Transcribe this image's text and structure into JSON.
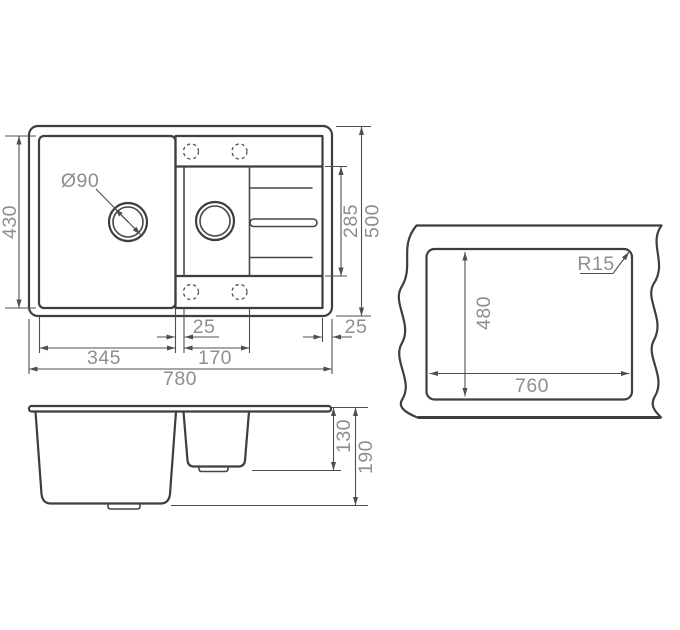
{
  "top_view": {
    "labels": {
      "total_width": "780",
      "main_bowl_width": "345",
      "bowl_gap": "25",
      "small_bowl_width": "170",
      "edge_offset": "25",
      "main_bowl_length": "430",
      "drain_section_length": "285",
      "total_length": "500",
      "drain_hole_diameter": "Ø90"
    }
  },
  "side_view": {
    "labels": {
      "small_bowl_depth": "130",
      "main_bowl_depth": "190"
    }
  },
  "cutout_view": {
    "labels": {
      "cutout_width": "760",
      "cutout_height": "480",
      "corner_radius": "R15"
    }
  },
  "colors": {
    "line": "#3e3e3e",
    "dimension_line": "#4f4f4f",
    "dimension_text": "#8e8e8e",
    "background": "#ffffff"
  }
}
